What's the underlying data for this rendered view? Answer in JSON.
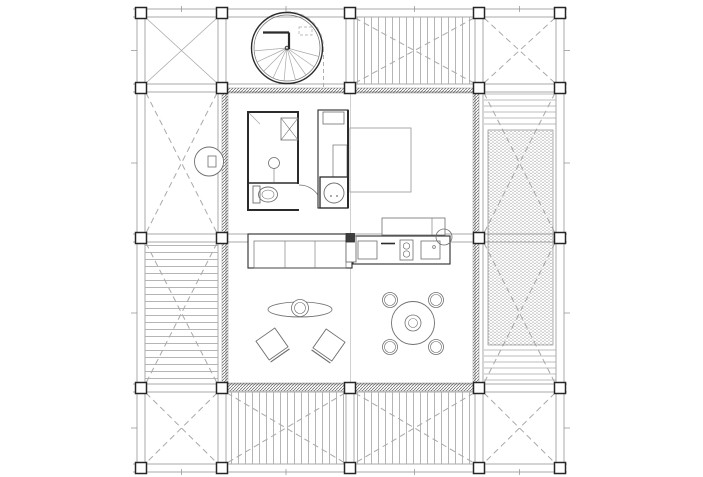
{
  "canvas": {
    "w": 703,
    "h": 477,
    "bg": "#ffffff"
  },
  "palette": {
    "ink": "#2b2b2b",
    "mid": "#6f6f6f",
    "soft": "#8d8d8d",
    "light": "#a9a9a9",
    "faint": "#c6c6c6"
  },
  "grid": {
    "cols": [
      141,
      222,
      350,
      479,
      560
    ],
    "rows": [
      13,
      88,
      238,
      388,
      468
    ],
    "skip": [
      [
        2,
        2
      ]
    ]
  },
  "structure": {
    "beams": {
      "v": [
        {
          "x": 141,
          "segs": [
            [
              8,
              472
            ]
          ]
        },
        {
          "x": 222,
          "segs": [
            [
              8,
              472
            ]
          ]
        },
        {
          "x": 350,
          "segs": [
            [
              8,
              93
            ],
            [
              383,
              472
            ]
          ]
        },
        {
          "x": 479,
          "segs": [
            [
              8,
              472
            ]
          ]
        },
        {
          "x": 560,
          "segs": [
            [
              8,
              472
            ]
          ]
        }
      ],
      "h": [
        {
          "y": 13,
          "segs": [
            [
              133,
              567
            ]
          ]
        },
        {
          "y": 88,
          "segs": [
            [
              133,
              567
            ]
          ]
        },
        {
          "y": 238,
          "segs": [
            [
              133,
              567
            ]
          ]
        },
        {
          "y": 388,
          "segs": [
            [
              133,
              567
            ]
          ]
        },
        {
          "y": 468,
          "segs": [
            [
              133,
              567
            ]
          ]
        }
      ]
    },
    "ticks": {
      "x": [
        181.5,
        286,
        414.5,
        519.5
      ],
      "y": [
        50.5,
        163,
        313,
        428
      ]
    }
  },
  "bays": [
    {
      "id": "A1",
      "x": 141,
      "y": 13,
      "w": 81,
      "h": 75,
      "deck": null,
      "cross": "solid"
    },
    {
      "id": "C1",
      "x": 350,
      "y": 13,
      "w": 129,
      "h": 75,
      "deck": "v",
      "cross": "dashed"
    },
    {
      "id": "D1",
      "x": 479,
      "y": 13,
      "w": 81,
      "h": 75,
      "deck": null,
      "cross": "dashed"
    },
    {
      "id": "A2",
      "x": 141,
      "y": 88,
      "w": 81,
      "h": 150,
      "deck": null,
      "cross": "dashed"
    },
    {
      "id": "D2",
      "x": 479,
      "y": 88,
      "w": 81,
      "h": 150,
      "deck": null,
      "cross": "dashed"
    },
    {
      "id": "A3",
      "x": 141,
      "y": 238,
      "w": 81,
      "h": 150,
      "deck": "h",
      "cross": "dashed"
    },
    {
      "id": "D3",
      "x": 479,
      "y": 238,
      "w": 81,
      "h": 150,
      "deck": null,
      "cross": "dashed"
    },
    {
      "id": "A4",
      "x": 141,
      "y": 388,
      "w": 81,
      "h": 80,
      "deck": null,
      "cross": "dashed"
    },
    {
      "id": "B4",
      "x": 222,
      "y": 388,
      "w": 128,
      "h": 80,
      "deck": "v",
      "cross": "dashed"
    },
    {
      "id": "C4",
      "x": 350,
      "y": 388,
      "w": 129,
      "h": 80,
      "deck": "v",
      "cross": "dashed"
    },
    {
      "id": "D4",
      "x": 479,
      "y": 388,
      "w": 81,
      "h": 80,
      "deck": null,
      "cross": "dashed"
    }
  ],
  "walls": [
    {
      "x": 222,
      "y": 88,
      "wd": 257,
      "ht": 5,
      "name": "north-wall"
    },
    {
      "x": 222,
      "y": 383,
      "wd": 257,
      "ht": 8,
      "name": "south-wall"
    },
    {
      "x": 222,
      "y": 88,
      "wd": 6,
      "ht": 303,
      "name": "west-wall"
    },
    {
      "x": 473,
      "y": 88,
      "wd": 6,
      "ht": 303,
      "name": "east-wall"
    }
  ],
  "elements": [
    {
      "t": "line",
      "x1": 350.5,
      "y1": 93,
      "x2": 350.5,
      "y2": 383,
      "s": "faint",
      "sw": 0.8,
      "name": "interior-grid-line"
    },
    {
      "t": "circle",
      "cx": 287,
      "cy": 48,
      "r": 35.5,
      "s": "ink",
      "sw": 1.4,
      "name": "spiral-stair-outer"
    },
    {
      "t": "circle",
      "cx": 287,
      "cy": 48,
      "r": 33,
      "s": "mid",
      "sw": 0.7,
      "name": "spiral-stair-inner"
    },
    {
      "t": "line",
      "x1": 287,
      "y1": 48,
      "x2": 318.9,
      "y2": 56.5,
      "s": "light",
      "sw": 0.7,
      "name": "stair-tread"
    },
    {
      "t": "line",
      "x1": 287,
      "y1": 48,
      "x2": 314.0,
      "y2": 66.9,
      "s": "light",
      "sw": 0.7,
      "name": "stair-tread"
    },
    {
      "t": "line",
      "x1": 287,
      "y1": 48,
      "x2": 305.9,
      "y2": 75.0,
      "s": "light",
      "sw": 0.7,
      "name": "stair-tread"
    },
    {
      "t": "line",
      "x1": 287,
      "y1": 48,
      "x2": 295.5,
      "y2": 79.9,
      "s": "light",
      "sw": 0.7,
      "name": "stair-tread"
    },
    {
      "t": "line",
      "x1": 287,
      "y1": 48,
      "x2": 284.1,
      "y2": 80.9,
      "s": "light",
      "sw": 0.7,
      "name": "stair-tread"
    },
    {
      "t": "line",
      "x1": 287,
      "y1": 48,
      "x2": 273.1,
      "y2": 77.9,
      "s": "light",
      "sw": 0.7,
      "name": "stair-tread"
    },
    {
      "t": "line",
      "x1": 287,
      "y1": 48,
      "x2": 263.7,
      "y2": 71.3,
      "s": "light",
      "sw": 0.7,
      "name": "stair-tread"
    },
    {
      "t": "line",
      "x1": 287,
      "y1": 48,
      "x2": 257.1,
      "y2": 61.9,
      "s": "light",
      "sw": 0.7,
      "name": "stair-tread"
    },
    {
      "t": "line",
      "x1": 287,
      "y1": 48,
      "x2": 254.1,
      "y2": 50.9,
      "s": "light",
      "sw": 0.7,
      "name": "stair-tread"
    },
    {
      "t": "circle",
      "cx": 287,
      "cy": 48,
      "r": 1.8,
      "s": "ink",
      "sw": 0.9,
      "name": "stair-pole"
    },
    {
      "t": "line",
      "x1": 263,
      "y1": 32.5,
      "x2": 289,
      "y2": 32.5,
      "s": "ink",
      "sw": 2.2,
      "name": "stair-wall"
    },
    {
      "t": "line",
      "x1": 289,
      "y1": 32.5,
      "x2": 289,
      "y2": 49,
      "s": "ink",
      "sw": 2.2,
      "name": "stair-wall"
    },
    {
      "t": "path",
      "d": "M287,11.5 A36.5,36.5 0 0 1 323.5,48",
      "s": "light",
      "sw": 0.9,
      "da": "4 3",
      "name": "stair-swing-dashed"
    },
    {
      "t": "line",
      "x1": 323.5,
      "y1": 48,
      "x2": 323.5,
      "y2": 90,
      "s": "light",
      "sw": 0.9,
      "da": "4 3",
      "name": "stair-projection-dashed"
    },
    {
      "t": "rect",
      "x": 299,
      "y": 27,
      "wd": 13,
      "ht": 8,
      "s": "light",
      "sw": 0.7,
      "da": "3 2",
      "name": "stair-landing-dashed"
    },
    {
      "t": "line",
      "x1": 247,
      "y1": 112,
      "x2": 299,
      "y2": 112,
      "s": "ink",
      "sw": 2,
      "name": "bathroom-wall"
    },
    {
      "t": "line",
      "x1": 248,
      "y1": 112,
      "x2": 248,
      "y2": 211,
      "s": "ink",
      "sw": 2,
      "name": "bathroom-wall"
    },
    {
      "t": "line",
      "x1": 247,
      "y1": 210,
      "x2": 299,
      "y2": 210,
      "s": "ink",
      "sw": 2,
      "name": "bathroom-wall"
    },
    {
      "t": "line",
      "x1": 298,
      "y1": 112,
      "x2": 298,
      "y2": 184,
      "s": "ink",
      "sw": 2,
      "name": "bathroom-wall"
    },
    {
      "t": "line",
      "x1": 248,
      "y1": 183,
      "x2": 298,
      "y2": 183,
      "s": "ink",
      "sw": 1.6,
      "name": "bathroom-divider-wall"
    },
    {
      "t": "rect",
      "x": 281,
      "y": 118,
      "wd": 17,
      "ht": 22,
      "s": "mid",
      "sw": 0.8,
      "name": "duct-shaft"
    },
    {
      "t": "line",
      "x1": 281,
      "y1": 118,
      "x2": 298,
      "y2": 140,
      "s": "mid",
      "sw": 0.6,
      "name": "duct-shaft-diagonal"
    },
    {
      "t": "line",
      "x1": 298,
      "y1": 118,
      "x2": 281,
      "y2": 140,
      "s": "mid",
      "sw": 0.6,
      "name": "duct-shaft-diagonal"
    },
    {
      "t": "line",
      "x1": 249,
      "y1": 113,
      "x2": 260,
      "y2": 124,
      "s": "light",
      "sw": 0.7,
      "name": "shower-corner-mark"
    },
    {
      "t": "circle",
      "cx": 274,
      "cy": 163,
      "r": 5.5,
      "s": "mid",
      "sw": 0.8,
      "name": "shower-drain"
    },
    {
      "t": "line",
      "x1": 274,
      "y1": 168.5,
      "x2": 274,
      "y2": 182,
      "s": "mid",
      "sw": 0.6,
      "name": "shower-drain-stem"
    },
    {
      "t": "rect",
      "x": 253,
      "y": 186,
      "wd": 7,
      "ht": 17,
      "s": "mid",
      "sw": 0.9,
      "name": "toilet-cistern"
    },
    {
      "t": "ellipse",
      "cx": 268,
      "cy": 194.5,
      "rx": 9.5,
      "ry": 7.5,
      "s": "mid",
      "sw": 0.9,
      "name": "toilet-bowl"
    },
    {
      "t": "ellipse",
      "cx": 268,
      "cy": 194.5,
      "rx": 6,
      "ry": 4.5,
      "s": "mid",
      "sw": 0.6,
      "name": "toilet-bowl-inner"
    },
    {
      "t": "path",
      "d": "M299,185 A23,23 0 0 1 322,208",
      "s": "mid",
      "sw": 0.7,
      "name": "bathroom-door-swing"
    },
    {
      "t": "rect",
      "x": 318,
      "y": 110,
      "wd": 30,
      "ht": 98,
      "s": "ink",
      "sw": 1.1,
      "f": "#ffffff",
      "name": "wardrobe"
    },
    {
      "t": "rect",
      "x": 323,
      "y": 112,
      "wd": 21,
      "ht": 12,
      "s": "mid",
      "sw": 0.8,
      "name": "wardrobe-drawer"
    },
    {
      "t": "rect",
      "x": 333,
      "y": 145,
      "wd": 14,
      "ht": 32,
      "s": "mid",
      "sw": 0.7,
      "name": "wardrobe-shelf"
    },
    {
      "t": "line",
      "x1": 348,
      "y1": 110,
      "x2": 348,
      "y2": 208,
      "s": "ink",
      "sw": 2,
      "name": "wardrobe-wall"
    },
    {
      "t": "rect",
      "x": 320,
      "y": 177,
      "wd": 28,
      "ht": 31,
      "s": "ink",
      "sw": 1.3,
      "name": "vanity"
    },
    {
      "t": "circle",
      "cx": 334,
      "cy": 193,
      "r": 10,
      "s": "mid",
      "sw": 0.9,
      "name": "washbasin"
    },
    {
      "t": "circle",
      "cx": 331,
      "cy": 196,
      "r": 0.9,
      "f": "#6f6f6f",
      "name": "faucet-dot"
    },
    {
      "t": "circle",
      "cx": 337,
      "cy": 196,
      "r": 0.9,
      "f": "#6f6f6f",
      "name": "faucet-dot"
    },
    {
      "t": "rect",
      "x": 350,
      "y": 128,
      "wd": 61,
      "ht": 64,
      "s": "light",
      "sw": 1,
      "f": "#ffffff",
      "name": "bed"
    },
    {
      "t": "rect",
      "x": 382,
      "y": 218,
      "wd": 63,
      "ht": 17,
      "s": "mid",
      "sw": 0.8,
      "f": "#ffffff",
      "name": "desk"
    },
    {
      "t": "line",
      "x1": 432,
      "y1": 218,
      "x2": 432,
      "y2": 235,
      "s": "mid",
      "sw": 0.6,
      "name": "desk-divider"
    },
    {
      "t": "rect",
      "x": 353,
      "y": 236,
      "wd": 97,
      "ht": 28,
      "s": "ink",
      "sw": 1.1,
      "f": "#ffffff",
      "name": "kitchen-counter"
    },
    {
      "t": "rect",
      "x": 358,
      "y": 241,
      "wd": 19,
      "ht": 18,
      "s": "mid",
      "sw": 0.8,
      "name": "counter-module"
    },
    {
      "t": "line",
      "x1": 381,
      "y1": 243.5,
      "x2": 395,
      "y2": 243.5,
      "s": "ink",
      "sw": 1.6,
      "name": "drawer-handle"
    },
    {
      "t": "rect",
      "x": 400,
      "y": 240,
      "wd": 13,
      "ht": 20,
      "s": "mid",
      "sw": 0.8,
      "name": "cooktop"
    },
    {
      "t": "circle",
      "cx": 406.5,
      "cy": 246,
      "r": 3.2,
      "s": "mid",
      "sw": 0.7,
      "name": "burner"
    },
    {
      "t": "circle",
      "cx": 406.5,
      "cy": 254,
      "r": 3.2,
      "s": "mid",
      "sw": 0.7,
      "name": "burner"
    },
    {
      "t": "rect",
      "x": 421,
      "y": 241,
      "wd": 19,
      "ht": 18,
      "s": "mid",
      "sw": 0.8,
      "name": "kitchen-sink"
    },
    {
      "t": "circle",
      "cx": 434,
      "cy": 247,
      "r": 1.4,
      "s": "mid",
      "sw": 0.7,
      "name": "sink-faucet"
    },
    {
      "t": "circle",
      "cx": 444,
      "cy": 237,
      "r": 8,
      "s": "mid",
      "sw": 0.8,
      "name": "counter-end-basin"
    },
    {
      "t": "rect",
      "x": 248,
      "y": 234,
      "wd": 104,
      "ht": 34,
      "s": "ink",
      "sw": 1.1,
      "f": "#ffffff",
      "name": "sofa"
    },
    {
      "t": "rect",
      "x": 254,
      "y": 241,
      "wd": 92,
      "ht": 27,
      "s": "mid",
      "sw": 0.7,
      "name": "sofa-seats"
    },
    {
      "t": "line",
      "x1": 285,
      "y1": 241,
      "x2": 285,
      "y2": 268,
      "s": "mid",
      "sw": 0.6,
      "name": "sofa-seat-divider"
    },
    {
      "t": "line",
      "x1": 315,
      "y1": 241,
      "x2": 315,
      "y2": 268,
      "s": "mid",
      "sw": 0.6,
      "name": "sofa-seat-divider"
    },
    {
      "t": "rect",
      "x": 346,
      "y": 236,
      "wd": 10,
      "ht": 26,
      "s": "mid",
      "sw": 0.9,
      "f": "#ffffff",
      "name": "sofa-side-table"
    },
    {
      "t": "ellipse",
      "cx": 300,
      "cy": 309.5,
      "rx": 32,
      "ry": 7.5,
      "s": "mid",
      "sw": 0.8,
      "name": "coffee-table"
    },
    {
      "t": "circle",
      "cx": 300,
      "cy": 308,
      "r": 8.5,
      "s": "mid",
      "sw": 0.8,
      "f": "#ffffff",
      "name": "coffee-table-bowl"
    },
    {
      "t": "circle",
      "cx": 300,
      "cy": 308,
      "r": 5.5,
      "s": "mid",
      "sw": 0.6,
      "name": "coffee-table-bowl-inner"
    },
    {
      "t": "chair",
      "cx": 272,
      "cy": 344,
      "rot": -35,
      "name": "armchair"
    },
    {
      "t": "chair",
      "cx": 329,
      "cy": 345,
      "rot": 35,
      "name": "armchair"
    },
    {
      "t": "circle",
      "cx": 413,
      "cy": 323,
      "r": 21.5,
      "s": "mid",
      "sw": 0.9,
      "f": "#ffffff",
      "name": "dining-table"
    },
    {
      "t": "circle",
      "cx": 413,
      "cy": 323,
      "r": 8,
      "s": "mid",
      "sw": 0.8,
      "name": "dining-table-center"
    },
    {
      "t": "circle",
      "cx": 413,
      "cy": 323,
      "r": 4.5,
      "s": "mid",
      "sw": 0.6,
      "name": "dining-table-center-inner"
    },
    {
      "t": "stool",
      "cx": 390,
      "cy": 300,
      "name": "dining-stool"
    },
    {
      "t": "stool",
      "cx": 436,
      "cy": 300,
      "name": "dining-stool"
    },
    {
      "t": "stool",
      "cx": 390,
      "cy": 347,
      "name": "dining-stool"
    },
    {
      "t": "stool",
      "cx": 436,
      "cy": 347,
      "name": "dining-stool"
    },
    {
      "t": "line",
      "x1": 484,
      "y1": 94,
      "x2": 556,
      "y2": 94,
      "s": "light",
      "sw": 0.75,
      "name": "louver-line"
    },
    {
      "t": "line",
      "x1": 484,
      "y1": 100,
      "x2": 556,
      "y2": 100,
      "s": "light",
      "sw": 0.75,
      "name": "louver-line"
    },
    {
      "t": "line",
      "x1": 484,
      "y1": 106,
      "x2": 556,
      "y2": 106,
      "s": "light",
      "sw": 0.75,
      "name": "louver-line"
    },
    {
      "t": "line",
      "x1": 484,
      "y1": 112,
      "x2": 556,
      "y2": 112,
      "s": "light",
      "sw": 0.75,
      "name": "louver-line"
    },
    {
      "t": "line",
      "x1": 484,
      "y1": 118,
      "x2": 556,
      "y2": 118,
      "s": "light",
      "sw": 0.75,
      "name": "louver-line"
    },
    {
      "t": "line",
      "x1": 484,
      "y1": 124,
      "x2": 556,
      "y2": 124,
      "s": "light",
      "sw": 0.75,
      "name": "louver-line"
    },
    {
      "t": "line",
      "x1": 484,
      "y1": 350,
      "x2": 556,
      "y2": 350,
      "s": "light",
      "sw": 0.75,
      "name": "louver-line"
    },
    {
      "t": "line",
      "x1": 484,
      "y1": 356,
      "x2": 556,
      "y2": 356,
      "s": "light",
      "sw": 0.75,
      "name": "louver-line"
    },
    {
      "t": "line",
      "x1": 484,
      "y1": 362,
      "x2": 556,
      "y2": 362,
      "s": "light",
      "sw": 0.75,
      "name": "louver-line"
    },
    {
      "t": "line",
      "x1": 484,
      "y1": 368,
      "x2": 556,
      "y2": 368,
      "s": "light",
      "sw": 0.75,
      "name": "louver-line"
    },
    {
      "t": "line",
      "x1": 484,
      "y1": 374,
      "x2": 556,
      "y2": 374,
      "s": "light",
      "sw": 0.75,
      "name": "louver-line"
    },
    {
      "t": "line",
      "x1": 484,
      "y1": 380,
      "x2": 556,
      "y2": 380,
      "s": "light",
      "sw": 0.75,
      "name": "louver-line"
    },
    {
      "t": "rect",
      "x": 488,
      "y": 130,
      "wd": 65,
      "ht": 215,
      "s": "soft",
      "sw": 0.7,
      "f": "stipple",
      "name": "planted-screen-panel"
    },
    {
      "t": "circle",
      "cx": 209,
      "cy": 161.5,
      "r": 14.5,
      "s": "mid",
      "sw": 0.9,
      "f": "#ffffff",
      "name": "porch-fixture"
    },
    {
      "t": "rect",
      "x": 208,
      "y": 156,
      "wd": 8,
      "ht": 11,
      "s": "mid",
      "sw": 0.8,
      "name": "porch-fixture-detail"
    },
    {
      "t": "rect",
      "x": 346,
      "y": 233.5,
      "wd": 8.5,
      "ht": 8.5,
      "s": "ink",
      "sw": 0.8,
      "f": "#3d3d3d",
      "name": "center-column"
    }
  ]
}
